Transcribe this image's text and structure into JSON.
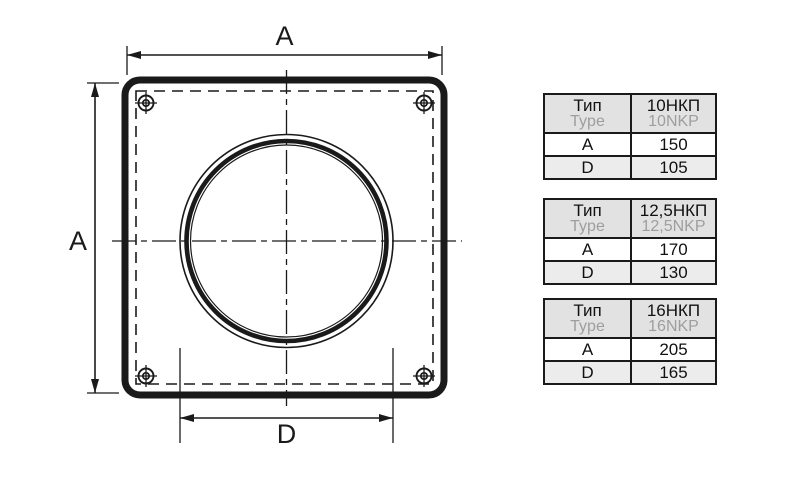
{
  "diagram": {
    "name": "square-flange-front-view",
    "width_label": "A",
    "height_label": "A",
    "diameter_label": "D"
  },
  "tables": [
    {
      "param_header_ru": "Тип",
      "param_header_en": "Type",
      "type_ru": "10НКП",
      "type_en": "10NKP",
      "rows": [
        {
          "param": "A",
          "value": "150"
        },
        {
          "param": "D",
          "value": "105"
        }
      ]
    },
    {
      "param_header_ru": "Тип",
      "param_header_en": "Type",
      "type_ru": "12,5НКП",
      "type_en": "12,5NKP",
      "rows": [
        {
          "param": "A",
          "value": "170"
        },
        {
          "param": "D",
          "value": "130"
        }
      ]
    },
    {
      "param_header_ru": "Тип",
      "param_header_en": "Type",
      "type_ru": "16НКП",
      "type_en": "16NKP",
      "rows": [
        {
          "param": "A",
          "value": "205"
        },
        {
          "param": "D",
          "value": "165"
        }
      ]
    }
  ],
  "colors": {
    "line": "#1a1a1a",
    "table_header_bg": "#e2e2e2",
    "table_alt_row_bg": "#ececec",
    "secondary_text": "#9e9e9e",
    "background": "#ffffff"
  }
}
